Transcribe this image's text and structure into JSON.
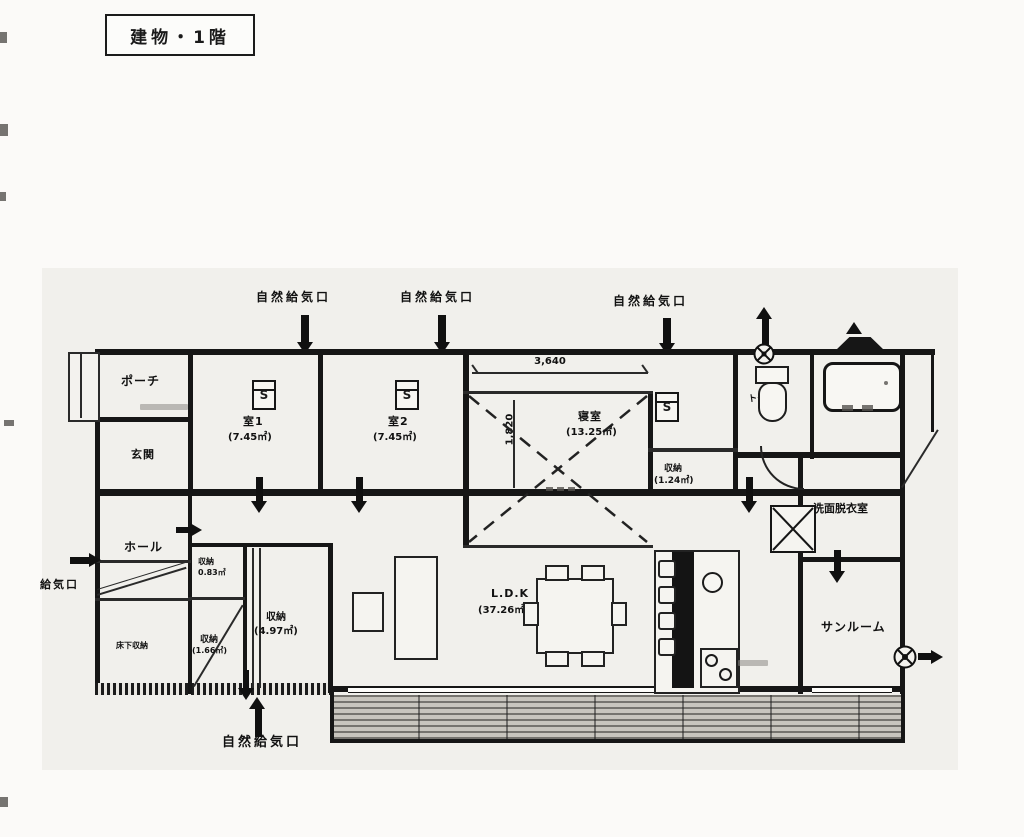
{
  "page": {
    "title_box": "建物・1階"
  },
  "labels": {
    "vent_natural": "自然給気口",
    "vent_supply": "給気口"
  },
  "dimensions": {
    "horizontal": "3,640",
    "vertical": "1,820"
  },
  "rooms": {
    "porch": {
      "name": "ポーチ"
    },
    "entrance": {
      "name": "玄関"
    },
    "room1": {
      "name": "室1",
      "area": "(7.45㎡)"
    },
    "room2": {
      "name": "室2",
      "area": "(7.45㎡)"
    },
    "bedroom": {
      "name": "寝室",
      "area": "(13.25㎡)"
    },
    "closet124": {
      "name": "収納",
      "area": "(1.24㎡)"
    },
    "toilet": {
      "name": "トイレ"
    },
    "hall": {
      "name": "ホール"
    },
    "storage083": {
      "name": "収納",
      "area": "0.83㎡"
    },
    "storage497": {
      "name": "収納",
      "area": "(4.97㎡)"
    },
    "storage166": {
      "name": "収納",
      "area": "(1.66㎡)"
    },
    "underfloor": {
      "name": "床下収納"
    },
    "ldk": {
      "name": "L.D.K",
      "area": "(37.26㎡)"
    },
    "washroom": {
      "name": "洗面脱衣室"
    },
    "sunroom": {
      "name": "サンルーム"
    }
  },
  "symbols": {
    "sensor": "S"
  },
  "colors": {
    "line": "#161616",
    "paper": "#f1f0ec",
    "deck_dark": "#76746f"
  }
}
